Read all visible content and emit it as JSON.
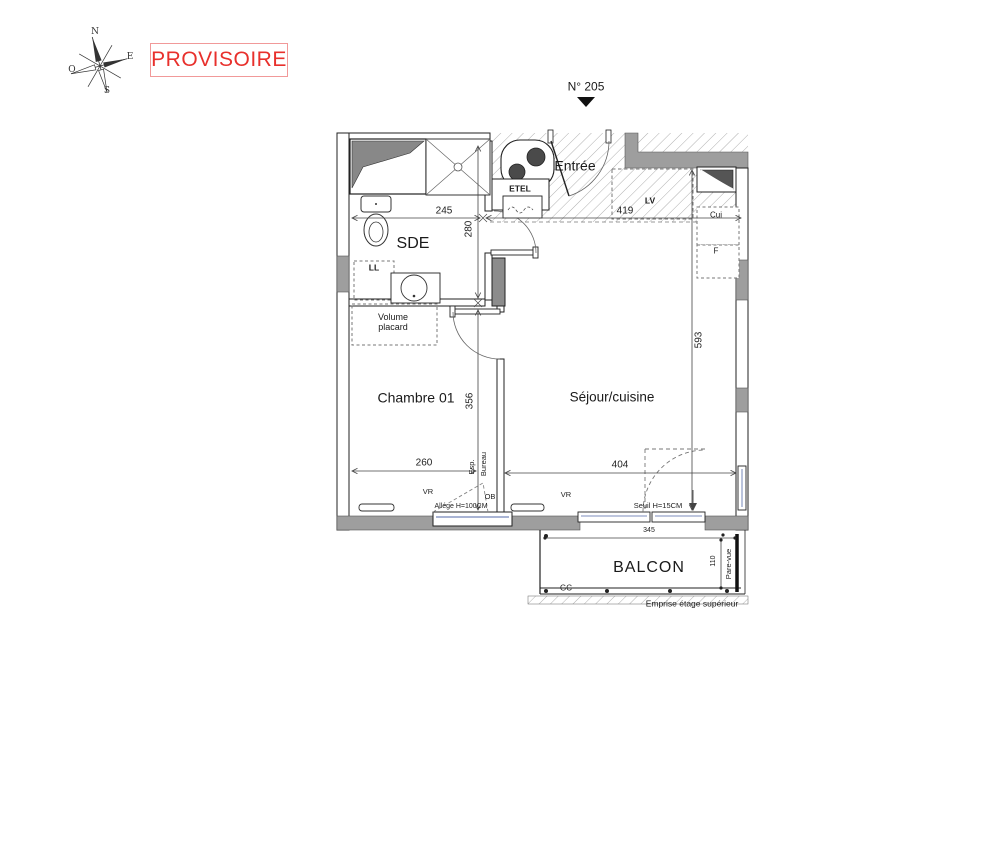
{
  "stamp": {
    "provisoire": "PROVISOIRE"
  },
  "compass": {
    "n": "N",
    "e": "E",
    "s": "S",
    "o": "O"
  },
  "unit": {
    "number": "N° 205"
  },
  "rooms": {
    "sde": "SDE",
    "entree": "Entrée",
    "chambre": "Chambre 01",
    "sejour": "Séjour/cuisine",
    "balcon": "BALCON"
  },
  "equipment": {
    "etel": "ETEL",
    "ll": "LL",
    "volume_placard": "Volume placard",
    "lv": "LV",
    "cui": "Cui",
    "f": "F"
  },
  "dimensions": {
    "d245": "245",
    "d280": "280",
    "d419": "419",
    "d593": "593",
    "d356": "356",
    "d260": "260",
    "d404": "404",
    "d345": "345",
    "d110": "110"
  },
  "annotations": {
    "vr1": "VR",
    "vr2": "VR",
    "ob": "OB",
    "esp": "Esp.",
    "bureau": "Bureau",
    "allege": "Allége H=100CM",
    "seuil": "Seuil H=15CM",
    "gc": "GC",
    "pare_vue": "Pare-vue",
    "emprise": "Emprise étage supérieur"
  },
  "colors": {
    "stamp_red": "#e8302c",
    "wall_gray": "#9e9e9e",
    "duct_gray": "#8c8c8c",
    "glazing_blue": "#a9b4d4"
  }
}
